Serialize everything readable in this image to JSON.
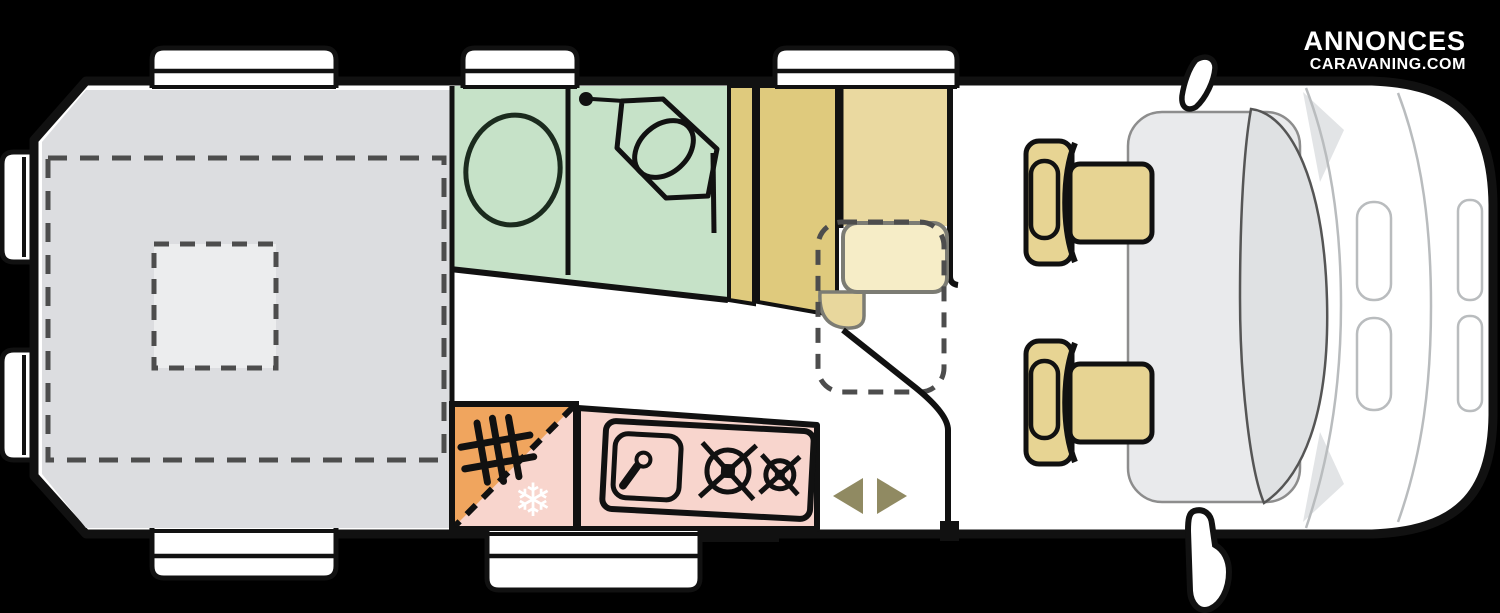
{
  "logo": {
    "line1": "ANNONCES",
    "line2": "CARAVANING.COM"
  },
  "floorplan": {
    "vehicle": "campervan top-view floor plan",
    "icons": {
      "snowflake": "❄"
    },
    "colors": {
      "background": "#000000",
      "body_fill": "#ffffff",
      "outline": "#111111",
      "bed": "#dcdde0",
      "bed_vent": "#ecedee",
      "dash": "#4d4d4d",
      "bathroom": "#c6e2c8",
      "wardrobe": "#dfca7d",
      "seat_back": "#ead9a0",
      "seat_cushion": "#f6edc7",
      "seat_bulge": "#e8d79d",
      "kitchen": "#f8d5cd",
      "heater": "#f0a55e",
      "snowflake": "#ffffff",
      "arrow": "#908a62",
      "cab_seat": "#e7d493",
      "cab_floor": "#e9eaec",
      "windshield": "#dfe1e3",
      "hood_line": "#b9bcbe"
    }
  }
}
